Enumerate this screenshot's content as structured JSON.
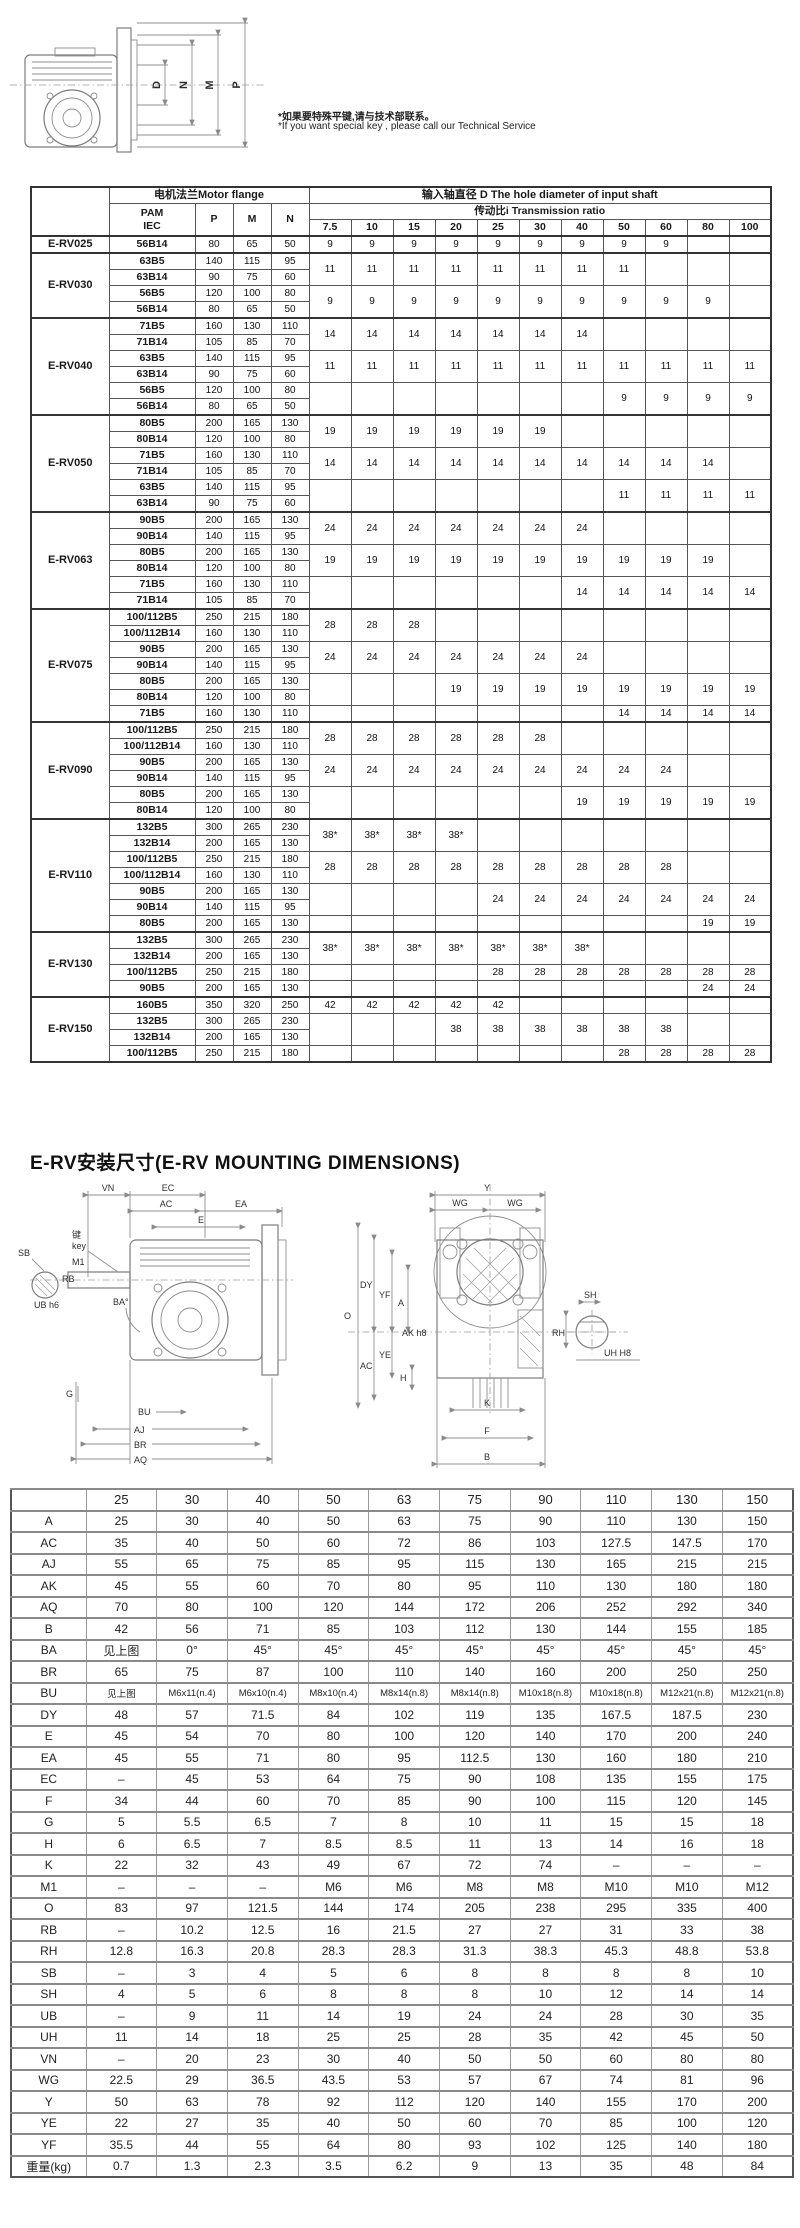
{
  "page": {
    "note_cn": "*如果要特殊平键,请与技术部联系。",
    "note_en": "*If you want  special key , please call our Technical Service",
    "section_title": "E-RV安装尺寸(E-RV MOUNTING DIMENSIONS)"
  },
  "top_drawing": {
    "dim_labels": [
      "D",
      "N",
      "M",
      "P"
    ]
  },
  "main_table": {
    "header": {
      "motor_flange": "电机法兰Motor flange",
      "input_shaft": "输入轴直径 D The hole diameter of input shaft",
      "pam": "PAM",
      "iec": "IEC",
      "p": "P",
      "m": "M",
      "n": "N",
      "ratio": "传动比i   Transmission ratio",
      "ratios": [
        "7.5",
        "10",
        "15",
        "20",
        "25",
        "30",
        "40",
        "50",
        "60",
        "80",
        "100"
      ]
    },
    "groups": [
      {
        "model": "E-RV025",
        "flanges": [
          [
            "56B14",
            "80",
            "65",
            "50"
          ]
        ],
        "d_groups": [
          {
            "v": "9",
            "from": 0,
            "to": 8,
            "span": 1
          }
        ]
      },
      {
        "model": "E-RV030",
        "flanges": [
          [
            "63B5",
            "140",
            "115",
            "95"
          ],
          [
            "63B14",
            "90",
            "75",
            "60"
          ],
          [
            "56B5",
            "120",
            "100",
            "80"
          ],
          [
            "56B14",
            "80",
            "65",
            "50"
          ]
        ],
        "d_groups": [
          {
            "v": "11",
            "from": 0,
            "to": 7,
            "span": 2
          },
          {
            "v": "9",
            "from": 0,
            "to": 9,
            "span": 2
          }
        ]
      },
      {
        "model": "E-RV040",
        "flanges": [
          [
            "71B5",
            "160",
            "130",
            "110"
          ],
          [
            "71B14",
            "105",
            "85",
            "70"
          ],
          [
            "63B5",
            "140",
            "115",
            "95"
          ],
          [
            "63B14",
            "90",
            "75",
            "60"
          ],
          [
            "56B5",
            "120",
            "100",
            "80"
          ],
          [
            "56B14",
            "80",
            "65",
            "50"
          ]
        ],
        "d_groups": [
          {
            "v": "14",
            "from": 0,
            "to": 6,
            "span": 2
          },
          {
            "v": "11",
            "from": 0,
            "to": 10,
            "span": 2
          },
          {
            "v": "9",
            "from": 7,
            "to": 10,
            "span": 2
          }
        ]
      },
      {
        "model": "E-RV050",
        "flanges": [
          [
            "80B5",
            "200",
            "165",
            "130"
          ],
          [
            "80B14",
            "120",
            "100",
            "80"
          ],
          [
            "71B5",
            "160",
            "130",
            "110"
          ],
          [
            "71B14",
            "105",
            "85",
            "70"
          ],
          [
            "63B5",
            "140",
            "115",
            "95"
          ],
          [
            "63B14",
            "90",
            "75",
            "60"
          ]
        ],
        "d_groups": [
          {
            "v": "19",
            "from": 0,
            "to": 5,
            "span": 2
          },
          {
            "v": "14",
            "from": 0,
            "to": 9,
            "span": 2
          },
          {
            "v": "11",
            "from": 7,
            "to": 10,
            "span": 2
          }
        ]
      },
      {
        "model": "E-RV063",
        "flanges": [
          [
            "90B5",
            "200",
            "165",
            "130"
          ],
          [
            "90B14",
            "140",
            "115",
            "95"
          ],
          [
            "80B5",
            "200",
            "165",
            "130"
          ],
          [
            "80B14",
            "120",
            "100",
            "80"
          ],
          [
            "71B5",
            "160",
            "130",
            "110"
          ],
          [
            "71B14",
            "105",
            "85",
            "70"
          ]
        ],
        "d_groups": [
          {
            "v": "24",
            "from": 0,
            "to": 6,
            "span": 2
          },
          {
            "v": "19",
            "from": 0,
            "to": 9,
            "span": 2
          },
          {
            "v": "14",
            "from": 6,
            "to": 10,
            "span": 2
          }
        ]
      },
      {
        "model": "E-RV075",
        "flanges": [
          [
            "100/112B5",
            "250",
            "215",
            "180"
          ],
          [
            "100/112B14",
            "160",
            "130",
            "110"
          ],
          [
            "90B5",
            "200",
            "165",
            "130"
          ],
          [
            "90B14",
            "140",
            "115",
            "95"
          ],
          [
            "80B5",
            "200",
            "165",
            "130"
          ],
          [
            "80B14",
            "120",
            "100",
            "80"
          ],
          [
            "71B5",
            "160",
            "130",
            "110"
          ]
        ],
        "d_groups": [
          {
            "v": "28",
            "from": 0,
            "to": 2,
            "span": 2
          },
          {
            "v": "24",
            "from": 0,
            "to": 6,
            "span": 2
          },
          {
            "v": "19",
            "from": 3,
            "to": 10,
            "span": 2
          },
          {
            "v": "14",
            "from": 7,
            "to": 10,
            "span": 1
          }
        ]
      },
      {
        "model": "E-RV090",
        "flanges": [
          [
            "100/112B5",
            "250",
            "215",
            "180"
          ],
          [
            "100/112B14",
            "160",
            "130",
            "110"
          ],
          [
            "90B5",
            "200",
            "165",
            "130"
          ],
          [
            "90B14",
            "140",
            "115",
            "95"
          ],
          [
            "80B5",
            "200",
            "165",
            "130"
          ],
          [
            "80B14",
            "120",
            "100",
            "80"
          ]
        ],
        "d_groups": [
          {
            "v": "28",
            "from": 0,
            "to": 5,
            "span": 2
          },
          {
            "v": "24",
            "from": 0,
            "to": 8,
            "span": 2
          },
          {
            "v": "19",
            "from": 6,
            "to": 10,
            "span": 2
          }
        ]
      },
      {
        "model": "E-RV110",
        "flanges": [
          [
            "132B5",
            "300",
            "265",
            "230"
          ],
          [
            "132B14",
            "200",
            "165",
            "130"
          ],
          [
            "100/112B5",
            "250",
            "215",
            "180"
          ],
          [
            "100/112B14",
            "160",
            "130",
            "110"
          ],
          [
            "90B5",
            "200",
            "165",
            "130"
          ],
          [
            "90B14",
            "140",
            "115",
            "95"
          ],
          [
            "80B5",
            "200",
            "165",
            "130"
          ]
        ],
        "d_groups": [
          {
            "v": "38*",
            "from": 0,
            "to": 3,
            "span": 2
          },
          {
            "v": "28",
            "from": 0,
            "to": 8,
            "span": 2
          },
          {
            "v": "24",
            "from": 4,
            "to": 10,
            "span": 2
          },
          {
            "v": "19",
            "from": 9,
            "to": 10,
            "span": 1
          }
        ]
      },
      {
        "model": "E-RV130",
        "flanges": [
          [
            "132B5",
            "300",
            "265",
            "230"
          ],
          [
            "132B14",
            "200",
            "165",
            "130"
          ],
          [
            "100/112B5",
            "250",
            "215",
            "180"
          ],
          [
            "90B5",
            "200",
            "165",
            "130"
          ]
        ],
        "d_groups": [
          {
            "v": "38*",
            "from": 0,
            "to": 6,
            "span": 2
          },
          {
            "v": "28",
            "from": 4,
            "to": 10,
            "span": 1
          },
          {
            "v": "24",
            "from": 9,
            "to": 10,
            "span": 1
          }
        ]
      },
      {
        "model": "E-RV150",
        "flanges": [
          [
            "160B5",
            "350",
            "320",
            "250"
          ],
          [
            "132B5",
            "300",
            "265",
            "230"
          ],
          [
            "132B14",
            "200",
            "165",
            "130"
          ],
          [
            "100/112B5",
            "250",
            "215",
            "180"
          ]
        ],
        "d_groups": [
          {
            "v": "42",
            "from": 0,
            "to": 4,
            "span": 1
          },
          {
            "v": "38",
            "from": 3,
            "to": 8,
            "span": 2
          },
          {
            "v": "28",
            "from": 7,
            "to": 10,
            "span": 1
          }
        ]
      }
    ]
  },
  "mounting": {
    "left_labels": [
      "VN",
      "EC",
      "AC",
      "EA",
      "E",
      "键",
      "key",
      "M1",
      "SB",
      "RB",
      "UB h6",
      "BA°",
      "G",
      "BU",
      "AJ",
      "BR",
      "AQ"
    ],
    "right_labels": [
      "Y",
      "WG",
      "WG",
      "DY",
      "YF",
      "A",
      "AK h8",
      "O",
      "YE",
      "AC",
      "H",
      "K",
      "F",
      "B"
    ],
    "shaft_labels": [
      "SH",
      "RH",
      "UH H8"
    ]
  },
  "dim_table": {
    "header": [
      "",
      "25",
      "30",
      "40",
      "50",
      "63",
      "75",
      "90",
      "110",
      "130",
      "150"
    ],
    "rows": [
      {
        "label": "A",
        "values": [
          "25",
          "30",
          "40",
          "50",
          "63",
          "75",
          "90",
          "110",
          "130",
          "150"
        ]
      },
      {
        "label": "AC",
        "values": [
          "35",
          "40",
          "50",
          "60",
          "72",
          "86",
          "103",
          "127.5",
          "147.5",
          "170"
        ]
      },
      {
        "label": "AJ",
        "values": [
          "55",
          "65",
          "75",
          "85",
          "95",
          "115",
          "130",
          "165",
          "215",
          "215"
        ]
      },
      {
        "label": "AK",
        "values": [
          "45",
          "55",
          "60",
          "70",
          "80",
          "95",
          "110",
          "130",
          "180",
          "180"
        ]
      },
      {
        "label": "AQ",
        "values": [
          "70",
          "80",
          "100",
          "120",
          "144",
          "172",
          "206",
          "252",
          "292",
          "340"
        ]
      },
      {
        "label": "B",
        "values": [
          "42",
          "56",
          "71",
          "85",
          "103",
          "112",
          "130",
          "144",
          "155",
          "185"
        ]
      },
      {
        "label": "BA",
        "values": [
          "见上图",
          "0°",
          "45°",
          "45°",
          "45°",
          "45°",
          "45°",
          "45°",
          "45°",
          "45°"
        ]
      },
      {
        "label": "BR",
        "values": [
          "65",
          "75",
          "87",
          "100",
          "110",
          "140",
          "160",
          "200",
          "250",
          "250"
        ]
      },
      {
        "label": "BU",
        "values": [
          "见上图",
          "M6x11(n.4)",
          "M6x10(n.4)",
          "M8x10(n.4)",
          "M8x14(n.8)",
          "M8x14(n.8)",
          "M10x18(n.8)",
          "M10x18(n.8)",
          "M12x21(n.8)",
          "M12x21(n.8)"
        ]
      },
      {
        "label": "DY",
        "values": [
          "48",
          "57",
          "71.5",
          "84",
          "102",
          "119",
          "135",
          "167.5",
          "187.5",
          "230"
        ]
      },
      {
        "label": "E",
        "values": [
          "45",
          "54",
          "70",
          "80",
          "100",
          "120",
          "140",
          "170",
          "200",
          "240"
        ]
      },
      {
        "label": "EA",
        "values": [
          "45",
          "55",
          "71",
          "80",
          "95",
          "112.5",
          "130",
          "160",
          "180",
          "210"
        ]
      },
      {
        "label": "EC",
        "values": [
          "–",
          "45",
          "53",
          "64",
          "75",
          "90",
          "108",
          "135",
          "155",
          "175"
        ]
      },
      {
        "label": "F",
        "values": [
          "34",
          "44",
          "60",
          "70",
          "85",
          "90",
          "100",
          "115",
          "120",
          "145"
        ]
      },
      {
        "label": "G",
        "values": [
          "5",
          "5.5",
          "6.5",
          "7",
          "8",
          "10",
          "11",
          "15",
          "15",
          "18"
        ]
      },
      {
        "label": "H",
        "values": [
          "6",
          "6.5",
          "7",
          "8.5",
          "8.5",
          "11",
          "13",
          "14",
          "16",
          "18"
        ]
      },
      {
        "label": "K",
        "values": [
          "22",
          "32",
          "43",
          "49",
          "67",
          "72",
          "74",
          "–",
          "–",
          "–"
        ]
      },
      {
        "label": "M1",
        "values": [
          "–",
          "–",
          "–",
          "M6",
          "M6",
          "M8",
          "M8",
          "M10",
          "M10",
          "M12"
        ]
      },
      {
        "label": "O",
        "values": [
          "83",
          "97",
          "121.5",
          "144",
          "174",
          "205",
          "238",
          "295",
          "335",
          "400"
        ]
      },
      {
        "label": "RB",
        "values": [
          "–",
          "10.2",
          "12.5",
          "16",
          "21.5",
          "27",
          "27",
          "31",
          "33",
          "38"
        ]
      },
      {
        "label": "RH",
        "values": [
          "12.8",
          "16.3",
          "20.8",
          "28.3",
          "28.3",
          "31.3",
          "38.3",
          "45.3",
          "48.8",
          "53.8"
        ]
      },
      {
        "label": "SB",
        "values": [
          "–",
          "3",
          "4",
          "5",
          "6",
          "8",
          "8",
          "8",
          "8",
          "10"
        ]
      },
      {
        "label": "SH",
        "values": [
          "4",
          "5",
          "6",
          "8",
          "8",
          "8",
          "10",
          "12",
          "14",
          "14"
        ]
      },
      {
        "label": "UB",
        "values": [
          "–",
          "9",
          "11",
          "14",
          "19",
          "24",
          "24",
          "28",
          "30",
          "35"
        ]
      },
      {
        "label": "UH",
        "values": [
          "11",
          "14",
          "18",
          "25",
          "25",
          "28",
          "35",
          "42",
          "45",
          "50"
        ]
      },
      {
        "label": "VN",
        "values": [
          "–",
          "20",
          "23",
          "30",
          "40",
          "50",
          "50",
          "60",
          "80",
          "80"
        ]
      },
      {
        "label": "WG",
        "values": [
          "22.5",
          "29",
          "36.5",
          "43.5",
          "53",
          "57",
          "67",
          "74",
          "81",
          "96"
        ]
      },
      {
        "label": "Y",
        "values": [
          "50",
          "63",
          "78",
          "92",
          "112",
          "120",
          "140",
          "155",
          "170",
          "200"
        ]
      },
      {
        "label": "YE",
        "values": [
          "22",
          "27",
          "35",
          "40",
          "50",
          "60",
          "70",
          "85",
          "100",
          "120"
        ]
      },
      {
        "label": "YF",
        "values": [
          "35.5",
          "44",
          "55",
          "64",
          "80",
          "93",
          "102",
          "125",
          "140",
          "180"
        ]
      },
      {
        "label": "重量(kg)",
        "values": [
          "0.7",
          "1.3",
          "2.3",
          "3.5",
          "6.2",
          "9",
          "13",
          "35",
          "48",
          "84"
        ]
      }
    ]
  }
}
